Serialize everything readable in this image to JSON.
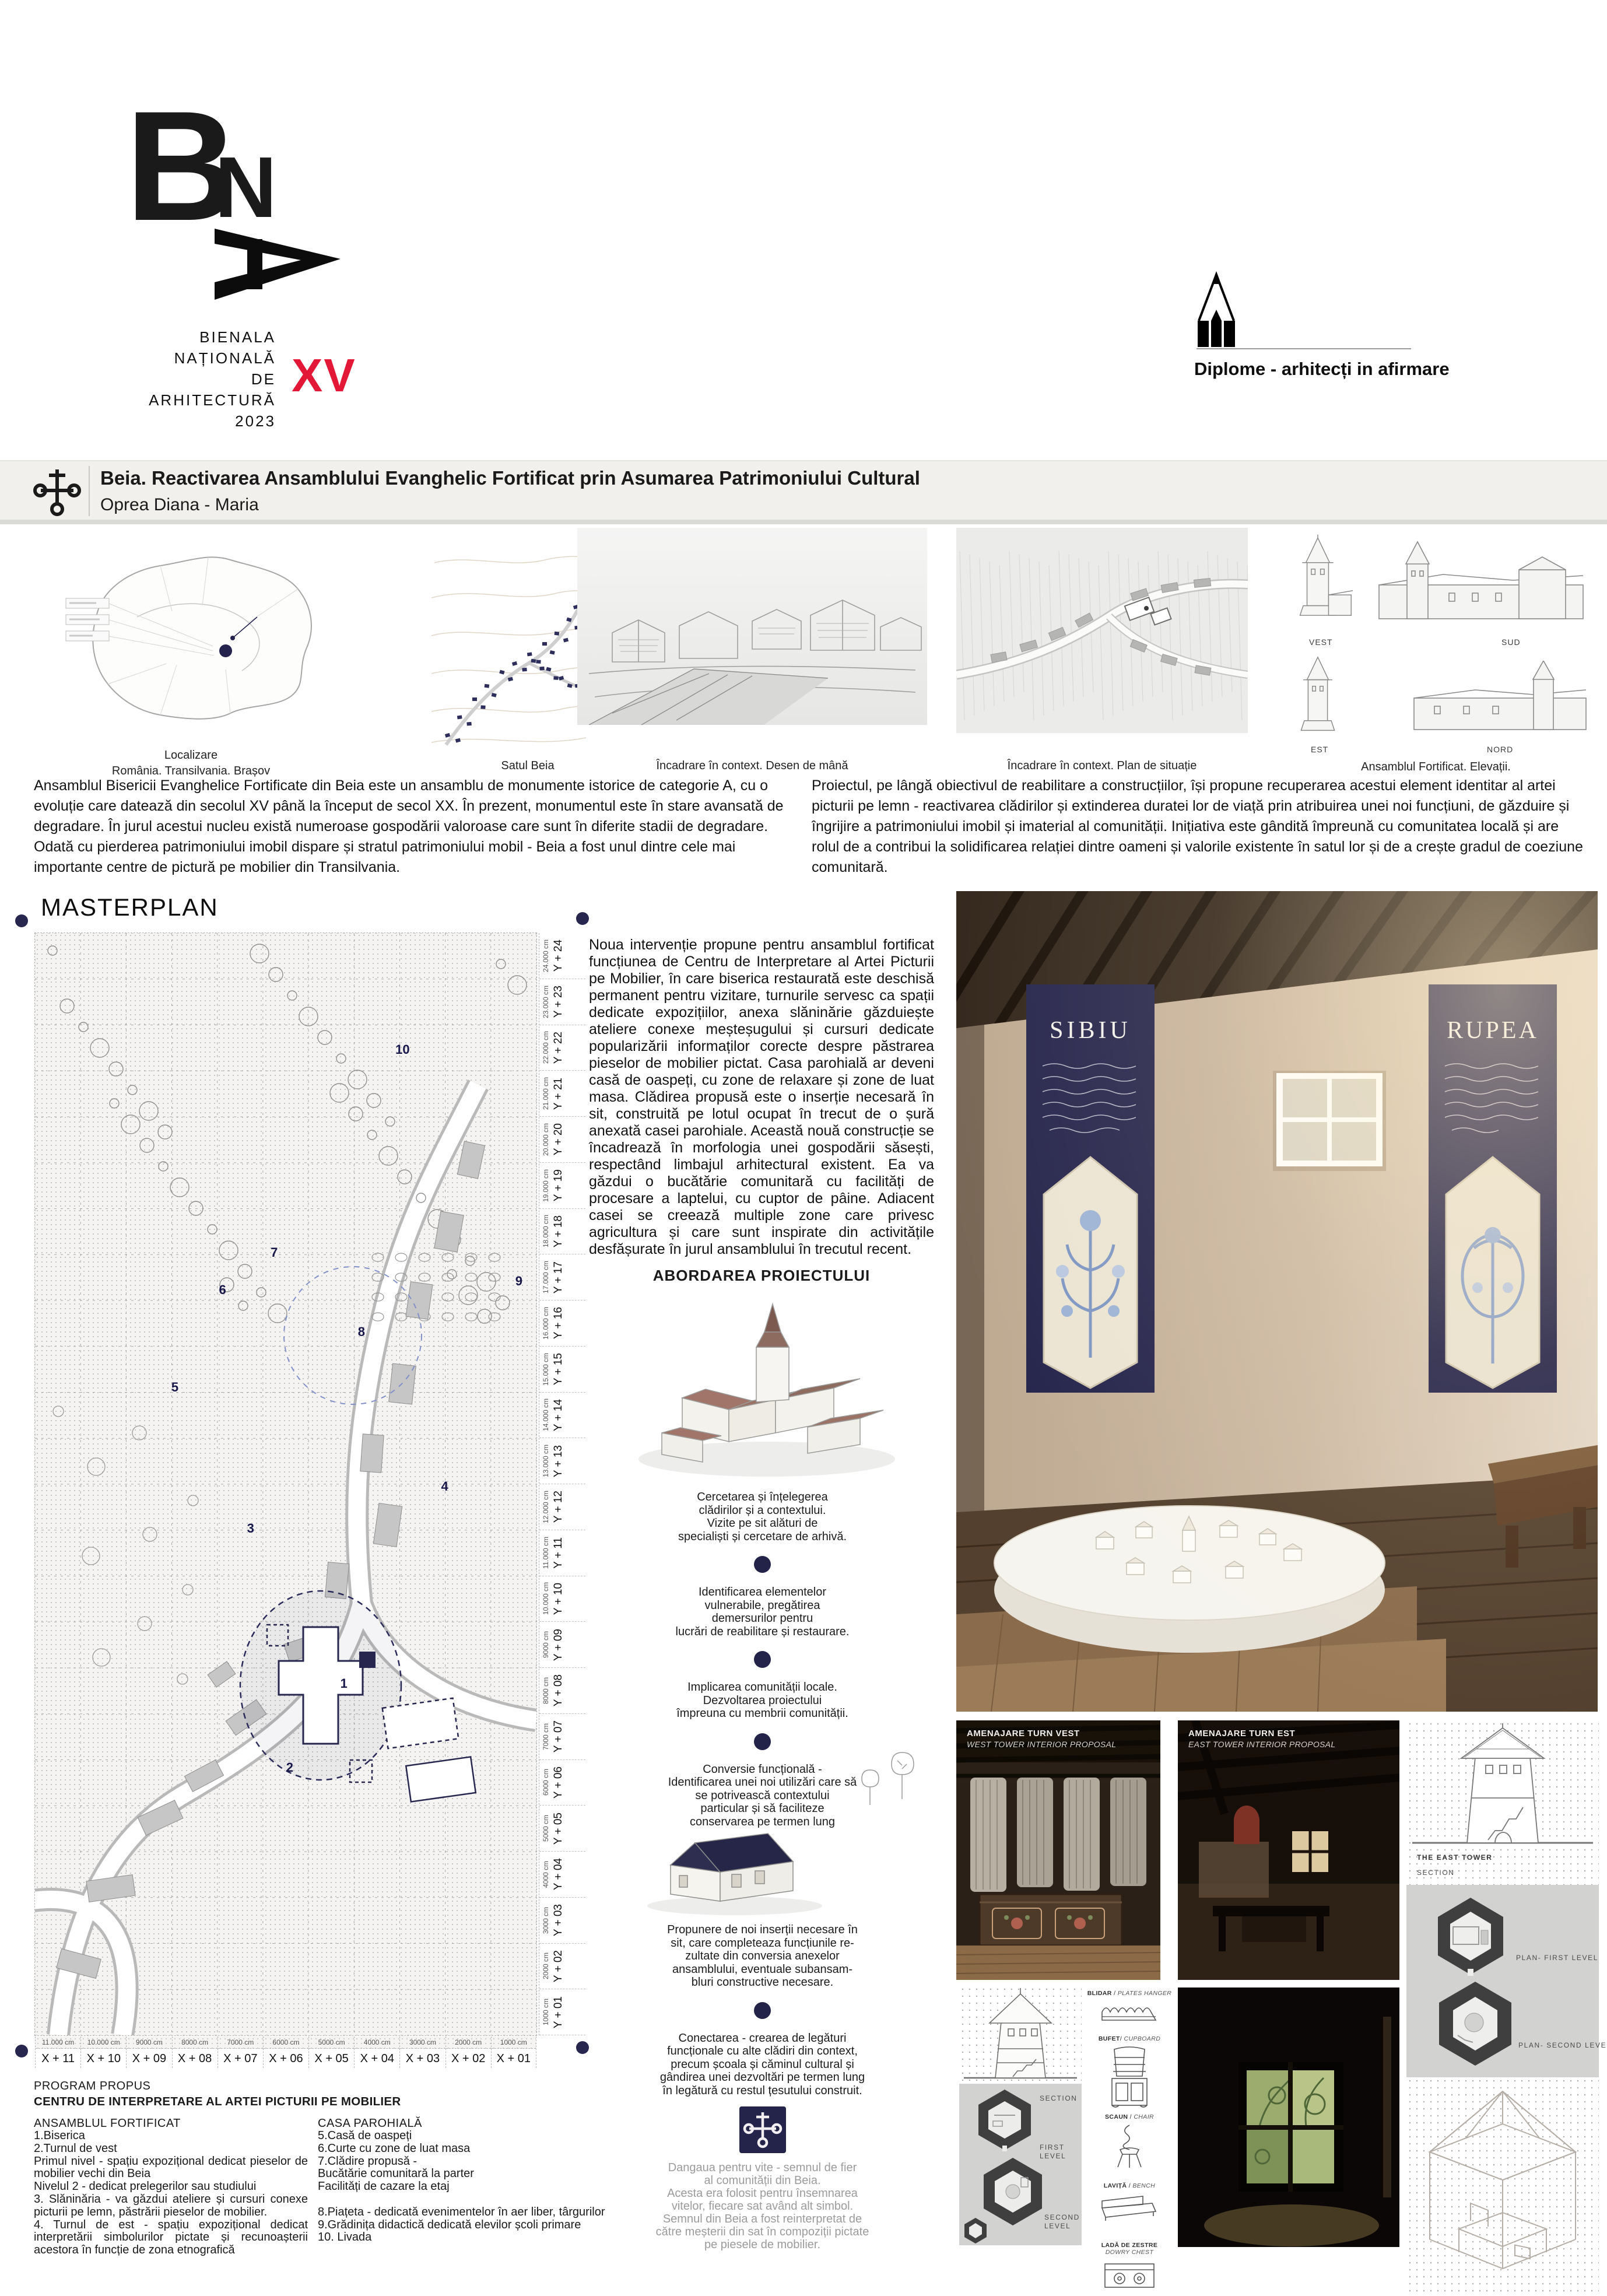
{
  "header": {
    "logo": {
      "letter_b": "B",
      "letter_n": "N",
      "lines": [
        "BIENALA",
        "NAȚIONALĂ",
        "DE",
        "ARHITECTURĂ",
        "2023"
      ],
      "edition": "XV"
    },
    "award_label": "Diplome - arhitecți in afirmare"
  },
  "title_bar": {
    "title": "Beia. Reactivarea Ansamblului Evanghelic Fortificat prin Asumarea Patrimoniului Cultural",
    "author": "Oprea Diana - Maria"
  },
  "maps": {
    "caption1a": "Localizare",
    "caption1b": "România. Transilvania. Brașov",
    "caption2": "Satul Beia",
    "caption3": "Încadrare în context. Desen de mână",
    "caption4": "Încadrare în context. Plan de situație",
    "caption5": "Ansamblul Fortificat. Elevații.",
    "elev_labels": [
      "VEST",
      "SUD",
      "EST",
      "NORD"
    ]
  },
  "intro": {
    "left": "Ansamblul Bisericii Evanghelice Fortificate din Beia este un ansamblu de monumente istorice de categorie A, cu o evoluție care datează din secolul XV până la început de secol XX. În prezent, monumentul este în stare avansată de degradare. În jurul acestui nucleu există numeroase gospodării valoroase care sunt în diferite stadii de degradare. Odată cu pierderea patrimoniului imobil dispare și stratul patrimoniului mobil - Beia a fost unul dintre cele mai importante centre de pictură pe mobilier din Transilvania.",
    "right": "Proiectul, pe lângă obiectivul de reabilitare a construcțiilor, își propune recuperarea acestui element identitar al artei picturii pe lemn - reactivarea clădirilor și extinderea duratei lor de viață prin atribuirea unei noi funcțiuni, de găzduire și îngrijire a patrimoniului imobil și imaterial al comunității. Inițiativa este gândită împreună cu comunitatea locală și are rolul de a contribui la solidificarea relației dintre oameni și valorile existente în satul lor și de a crește gradul de coeziune comunitară."
  },
  "masterplan": {
    "title": "MASTERPLAN",
    "description": "Noua intervenție propune pentru ansamblul fortificat funcțiunea de Centru de Interpretare al Artei Picturii pe Mobilier, în care biserica restaurată este deschisă permanent pentru vizitare, turnurile servesc ca spații dedicate expozițiilor, anexa slăninărie găzduiește ateliere conexe meșteșugului și cursuri dedicate popularizării informaților corecte despre păstrarea pieselor de mobilier pictat. Casa parohială ar deveni casă de oaspeți, cu zone de relaxare și zone de luat masa. Clădirea propusă este o inserție necesară în sit, construită pe lotul ocupat în trecut de o șură anexată casei parohiale. Această nouă construcție se încadrează în morfologia unei gospodării săsești, respectând limbajul arhitectural existent. Ea va găzdui o bucătărie comunitară cu facilități de procesare a laptelui, cu cuptor de pâine. Adiacent casei se creează multiple zone care privesc agricultura și care sunt inspirate din activitățile desfășurate în jurul ansamblului în trecutul recent.",
    "y_axis": [
      {
        "label": "Y + 24",
        "dim": "24.000 cm"
      },
      {
        "label": "Y + 23",
        "dim": "23.000 cm"
      },
      {
        "label": "Y + 22",
        "dim": "22.000 cm"
      },
      {
        "label": "Y + 21",
        "dim": "21.000 cm"
      },
      {
        "label": "Y + 20",
        "dim": "20.000 cm"
      },
      {
        "label": "Y + 19",
        "dim": "19.000 cm"
      },
      {
        "label": "Y + 18",
        "dim": "18.000 cm"
      },
      {
        "label": "Y + 17",
        "dim": "17.000 cm"
      },
      {
        "label": "Y + 16",
        "dim": "16.000 cm"
      },
      {
        "label": "Y + 15",
        "dim": "15.000 cm"
      },
      {
        "label": "Y + 14",
        "dim": "14.000 cm"
      },
      {
        "label": "Y + 13",
        "dim": "13.000 cm"
      },
      {
        "label": "Y + 12",
        "dim": "12.000 cm"
      },
      {
        "label": "Y + 11",
        "dim": "11.000 cm"
      },
      {
        "label": "Y + 10",
        "dim": "10.000 cm"
      },
      {
        "label": "Y + 09",
        "dim": "9000 cm"
      },
      {
        "label": "Y + 08",
        "dim": "8000 cm"
      },
      {
        "label": "Y + 07",
        "dim": "7000 cm"
      },
      {
        "label": "Y + 06",
        "dim": "6000 cm"
      },
      {
        "label": "Y + 05",
        "dim": "5000 cm"
      },
      {
        "label": "Y + 04",
        "dim": "4000 cm"
      },
      {
        "label": "Y + 03",
        "dim": "3000 cm"
      },
      {
        "label": "Y + 02",
        "dim": "2000 cm"
      },
      {
        "label": "Y + 01",
        "dim": "1000 cm"
      }
    ],
    "x_axis": [
      {
        "label": "X + 11",
        "dim": "11.000 cm"
      },
      {
        "label": "X + 10",
        "dim": "10.000 cm"
      },
      {
        "label": "X + 09",
        "dim": "9000 cm"
      },
      {
        "label": "X + 08",
        "dim": "8000 cm"
      },
      {
        "label": "X + 07",
        "dim": "7000 cm"
      },
      {
        "label": "X + 06",
        "dim": "6000 cm"
      },
      {
        "label": "X + 05",
        "dim": "5000 cm"
      },
      {
        "label": "X + 04",
        "dim": "4000 cm"
      },
      {
        "label": "X + 03",
        "dim": "3000 cm"
      },
      {
        "label": "X + 02",
        "dim": "2000 cm"
      },
      {
        "label": "X + 01",
        "dim": "1000 cm"
      }
    ],
    "markers": [
      "1",
      "2",
      "3",
      "4",
      "5",
      "6",
      "7",
      "8",
      "9",
      "10"
    ]
  },
  "approach": {
    "heading": "ABORDAREA PROIECTULUI",
    "steps": [
      "Cercetarea și înțelegerea\nclădirilor și a contextului.\nVizite pe sit alături de\nspecialiști și cercetare de arhivă.",
      "Identificarea elementelor\nvulnerabile, pregătirea\ndemersurilor pentru\nlucrări de reabilitare și restaurare.",
      "Implicarea comunității locale.\nDezvoltarea proiectului\nîmpreuna cu membrii comunității.",
      "Conversie funcțională -\nIdentificarea unei noi utilizări care să\nse potrivească contextului\nparticular și să faciliteze\nconservarea pe termen lung",
      "Propunere de noi inserții necesare în\nsit, care completeaza funcțiunile re-\nzultate din conversia anexelor\nansamblului, eventuale subansam-\nbluri constructive necesare.",
      "Conectarea  - crearea de legături\nfuncționale cu alte clădiri din context,\nprecum școala și căminul cultural și\ngândirea unei dezvoltări pe termen lung\nîn legătură cu restul țesutului construit."
    ],
    "symbol_caption": "Dangaua pentru vite - semnul de fier\nal comunității din Beia.\nAcesta era folosit pentru însemnarea\nvitelor, fiecare sat având alt simbol.\nSemnul din Beia a fost reinterpretat de\ncătre meșterii din sat în compoziții pictate\npe piesele de mobilier."
  },
  "program": {
    "label": "PROGRAM PROPUS",
    "heading": "CENTRU DE INTERPRETARE AL ARTEI PICTURII PE MOBILIER",
    "col1_title": "ANSAMBLUL FORTIFICAT",
    "col1": [
      "1.Biserica",
      "2.Turnul de vest",
      "Primul nivel - spațiu expozițional dedicat pieselor de mobilier vechi din Beia",
      "Nivelul 2 - dedicat prelegerilor sau studiului",
      "3. Slăninăria - va găzdui ateliere și cursuri conexe picturii pe lemn, păstrării pieselor de mobilier.",
      "4. Turnul de est - spațiu expozițional dedicat interpretării simbolurilor pictate și recunoașterii acestora în funcție de zona etnografică"
    ],
    "col2_title": "CASA PAROHIALĂ",
    "col2": [
      "5.Casă de oaspeți",
      "6.Curte cu zone de luat masa",
      "7.Clădire propusă -",
      "Bucătărie comunitară la parter",
      "Facilități de cazare la etaj",
      "",
      "8.Piațeta - dedicată evenimentelor în aer liber, târgurilor",
      "9.Grădinița didactică dedicată elevilor școli primare",
      "10. Livada"
    ]
  },
  "render": {
    "banner_left": "SIBIU",
    "banner_right": "RUPEA"
  },
  "panels": {
    "vest_title": "AMENAJARE TURN VEST",
    "vest_sub": "WEST TOWER INTERIOR PROPOSAL",
    "est_title": "AMENAJARE TURN EST",
    "est_sub": "EAST TOWER INTERIOR PROPOSAL",
    "west_section": "SECTION",
    "west_first": "FIRST LEVEL",
    "west_second": "SECOND LEVEL",
    "east_name": "THE EAST TOWER",
    "east_section": "SECTION",
    "east_plan1": "PLAN- FIRST LEVEL",
    "east_plan2": "PLAN- SECOND LEVEL"
  },
  "furniture": [
    {
      "ro": "BLIDAR",
      "en": "PLATES HANGER"
    },
    {
      "ro": "BUFET",
      "en": "CUPBOARD"
    },
    {
      "ro": "SCAUN",
      "en": "CHAIR"
    },
    {
      "ro": "LAVIȚĂ",
      "en": "BENCH"
    },
    {
      "ro": "LADĂ DE ZESTRE",
      "en": "DOWRY CHEST"
    }
  ],
  "colors": {
    "navy": "#26264f",
    "red": "#e31837"
  }
}
